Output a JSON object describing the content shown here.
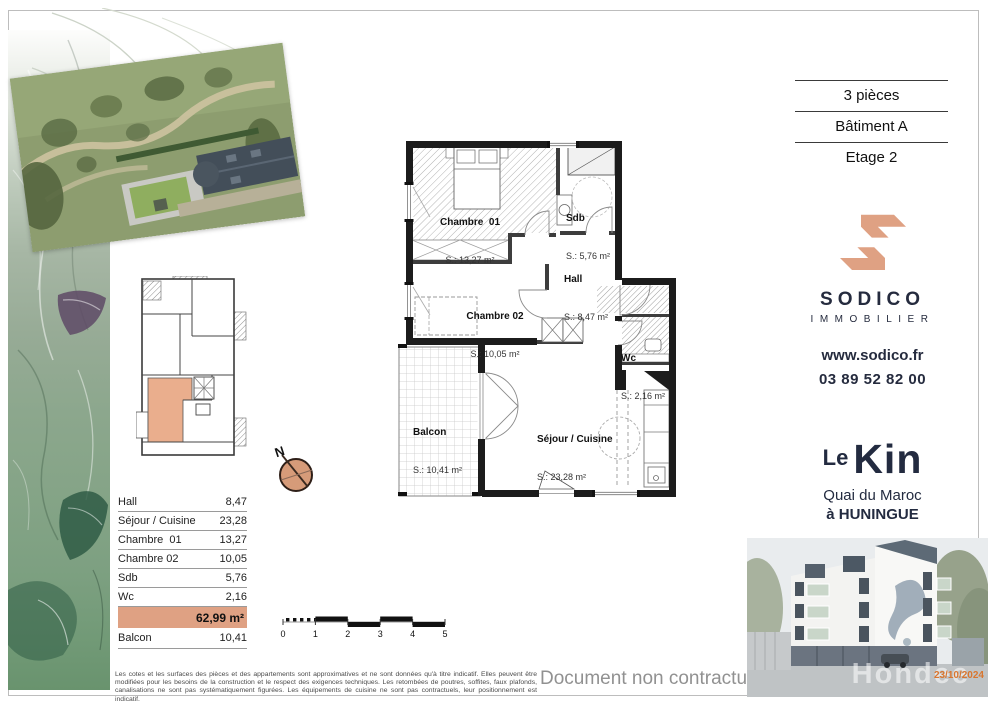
{
  "header": {
    "pieces": "3 pièces",
    "batiment": "Bâtiment A",
    "etage": "Etage 2"
  },
  "agency": {
    "name": "SODICO",
    "tagline": "IMMOBILIER",
    "website": "www.sodico.fr",
    "phone": "03 89 52 82 00",
    "brand_color": "#dfa183",
    "navy_color": "#252b3e"
  },
  "residence": {
    "prefix": "Le",
    "name": "Kin",
    "address1": "Quai du Maroc",
    "address2": "à HUNINGUE"
  },
  "plan": {
    "rooms": [
      {
        "name": "Chambre  01",
        "area": "S.: 13,27 m²"
      },
      {
        "name": "Sdb",
        "area": "S.: 5,76 m²"
      },
      {
        "name": "Hall",
        "area": "S.: 8,47 m²"
      },
      {
        "name": "Chambre 02",
        "area": "S.: 10,05 m²"
      },
      {
        "name": "Wc",
        "area": "S.: 2,16 m²"
      },
      {
        "name": "Balcon",
        "area": "S.: 10,41 m²"
      },
      {
        "name": "Séjour / Cuisine",
        "area": "S.: 23,28 m²"
      }
    ],
    "compass": "N",
    "scale_ticks": [
      "0",
      "1",
      "2",
      "3",
      "4",
      "5"
    ]
  },
  "table": {
    "rows": [
      {
        "label": "Hall",
        "value": "8,47"
      },
      {
        "label": "Séjour / Cuisine",
        "value": "23,28"
      },
      {
        "label": "Chambre  01",
        "value": "13,27"
      },
      {
        "label": "Chambre 02",
        "value": "10,05"
      },
      {
        "label": "Sdb",
        "value": "5,76"
      },
      {
        "label": "Wc",
        "value": "2,16"
      }
    ],
    "total": "62,99 m²",
    "balcony": {
      "label": "Balcon",
      "value": "10,41"
    }
  },
  "footer": {
    "disclaimer": "Les cotes et les surfaces des pièces et des appartements sont approximatives et ne sont données qu'à titre indicatif. Elles peuvent être modifiées pour les besoins de la construction et le respect des exigences techniques. Les retombées de poutres, soffites, faux plafonds, canalisations ne sont pas systématiquement figurées. Les équipements de cuisine ne sont pas contractuels, leur positionnement est indicatif.",
    "notice": "Document non contractuel",
    "watermark": "Hondee",
    "date": "23/10/2024"
  }
}
